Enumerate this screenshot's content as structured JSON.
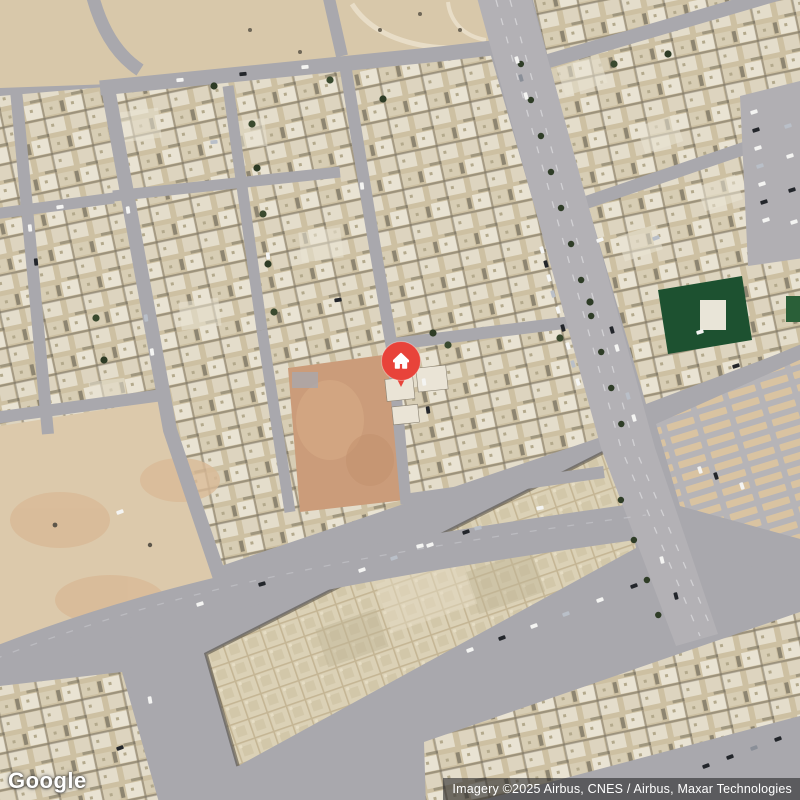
{
  "branding": {
    "logo_text": "Google"
  },
  "attribution": {
    "text": "Imagery ©2025 Airbus, CNES / Airbus, Maxar Technologies"
  },
  "map": {
    "view_type": "satellite",
    "marker": {
      "name": "home-location",
      "glyph": "home",
      "x": 401,
      "y": 361,
      "color": "#e8433a",
      "glyph_color": "#ffffff"
    },
    "palette": {
      "road": "#a9a8ad",
      "avenue": "#b3b1b5",
      "sand": "#d8c8aa",
      "dirt_lot": "#cb9c7a",
      "building_base": "#cdc0a2",
      "building_light": "#e9e3d3",
      "school_roof": "#dbd1b6",
      "green_roof": "#1d5130",
      "tree": "#3a4a2f",
      "parking_stall": "#d9c3a1"
    },
    "decor": {
      "car_colors": [
        "#f4f4f2",
        "#23262b",
        "#b9bfc8",
        "#8a8f98"
      ],
      "cars": [
        [
          542,
          250,
          74,
          0
        ],
        [
          546,
          264,
          74,
          1
        ],
        [
          549,
          278,
          74,
          0
        ],
        [
          553,
          294,
          74,
          2
        ],
        [
          558,
          310,
          74,
          0
        ],
        [
          563,
          328,
          74,
          1
        ],
        [
          568,
          346,
          74,
          0
        ],
        [
          573,
          364,
          74,
          2
        ],
        [
          578,
          382,
          74,
          0
        ],
        [
          612,
          330,
          74,
          1
        ],
        [
          617,
          348,
          74,
          0
        ],
        [
          628,
          396,
          74,
          2
        ],
        [
          634,
          418,
          74,
          0
        ],
        [
          517,
          60,
          74,
          0
        ],
        [
          521,
          78,
          74,
          3
        ],
        [
          526,
          96,
          74,
          0
        ],
        [
          662,
          560,
          76,
          0
        ],
        [
          676,
          596,
          76,
          1
        ],
        [
          754,
          112,
          -18,
          0
        ],
        [
          756,
          130,
          -18,
          1
        ],
        [
          758,
          148,
          -18,
          0
        ],
        [
          760,
          166,
          -18,
          2
        ],
        [
          762,
          184,
          -18,
          0
        ],
        [
          764,
          202,
          -18,
          1
        ],
        [
          766,
          220,
          -18,
          0
        ],
        [
          788,
          126,
          -18,
          2
        ],
        [
          790,
          156,
          -18,
          0
        ],
        [
          792,
          190,
          -18,
          1
        ],
        [
          794,
          222,
          -18,
          0
        ],
        [
          180,
          80,
          -6,
          0
        ],
        [
          243,
          74,
          -6,
          1
        ],
        [
          305,
          67,
          -6,
          0
        ],
        [
          60,
          207,
          -8,
          0
        ],
        [
          36,
          262,
          84,
          1
        ],
        [
          30,
          228,
          84,
          0
        ],
        [
          128,
          210,
          82,
          0
        ],
        [
          146,
          318,
          82,
          2
        ],
        [
          152,
          352,
          82,
          0
        ],
        [
          200,
          604,
          -18,
          0
        ],
        [
          262,
          584,
          -16,
          1
        ],
        [
          420,
          546,
          -14,
          0
        ],
        [
          478,
          528,
          -12,
          2
        ],
        [
          540,
          508,
          -10,
          0
        ],
        [
          470,
          650,
          -20,
          0
        ],
        [
          502,
          638,
          -20,
          1
        ],
        [
          534,
          626,
          -20,
          0
        ],
        [
          566,
          614,
          -20,
          2
        ],
        [
          600,
          600,
          -20,
          0
        ],
        [
          634,
          586,
          -20,
          1
        ],
        [
          362,
          570,
          -19,
          0
        ],
        [
          394,
          558,
          -19,
          2
        ],
        [
          430,
          545,
          -19,
          0
        ],
        [
          466,
          532,
          -19,
          1
        ],
        [
          424,
          382,
          82,
          0
        ],
        [
          428,
          410,
          82,
          1
        ],
        [
          600,
          240,
          -20,
          0
        ],
        [
          656,
          238,
          -20,
          2
        ],
        [
          700,
          332,
          -18,
          0
        ],
        [
          736,
          366,
          -18,
          1
        ],
        [
          700,
          470,
          72,
          0
        ],
        [
          716,
          476,
          72,
          1
        ],
        [
          742,
          486,
          72,
          0
        ],
        [
          214,
          142,
          -6,
          2
        ],
        [
          268,
          256,
          84,
          0
        ],
        [
          338,
          300,
          -8,
          1
        ],
        [
          362,
          186,
          84,
          0
        ],
        [
          120,
          512,
          -20,
          0
        ],
        [
          150,
          700,
          80,
          0
        ],
        [
          120,
          748,
          -20,
          1
        ],
        [
          706,
          766,
          -20,
          1
        ],
        [
          730,
          757,
          -20,
          1
        ],
        [
          754,
          748,
          -20,
          3
        ],
        [
          778,
          739,
          -20,
          1
        ]
      ],
      "trees": [
        [
          252,
          124
        ],
        [
          257,
          168
        ],
        [
          263,
          214
        ],
        [
          268,
          264
        ],
        [
          274,
          312
        ],
        [
          433,
          333
        ],
        [
          448,
          345
        ],
        [
          383,
          99
        ],
        [
          560,
          338
        ],
        [
          590,
          302
        ],
        [
          614,
          64
        ],
        [
          668,
          54
        ],
        [
          330,
          80
        ],
        [
          214,
          86
        ],
        [
          96,
          318
        ],
        [
          104,
          360
        ]
      ],
      "median_bushes_upper_y": [
        64,
        100,
        136,
        172,
        208,
        244,
        280,
        316,
        352,
        388,
        424
      ],
      "median_bushes_lower_y": [
        500,
        540,
        580,
        615
      ]
    }
  }
}
